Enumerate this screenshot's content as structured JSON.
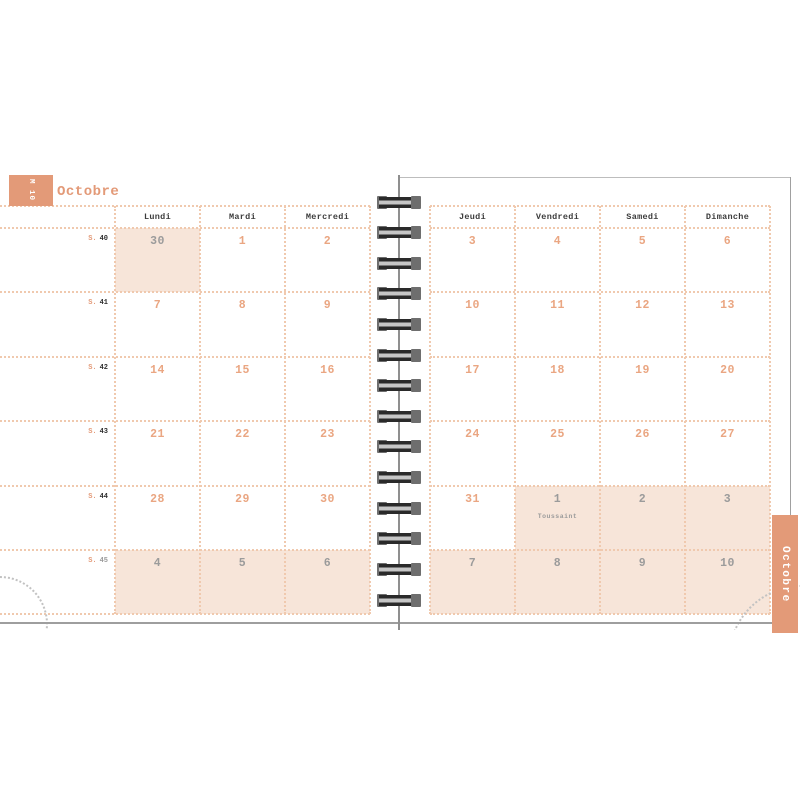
{
  "header": {
    "month_tab": "M 10",
    "title": "Octobre",
    "side_tab": "Octobre"
  },
  "colors": {
    "accent": "#E39A78",
    "cell_shade": "#F7E5D9",
    "day_number": "#EAA682",
    "muted_number": "#9B9B9B",
    "grid_dot": "#F0C9AE",
    "header_ink": "#3C3C3C",
    "week_ink": "#2E2E2E",
    "tab_text": "#FFFFFF",
    "ring_cap": "#6E6E6E",
    "ring_bar": "#2A2A2A"
  },
  "calendar": {
    "week_prefix": "S.",
    "left_day_headers": [
      "Lundi",
      "Mardi",
      "Mercredi"
    ],
    "right_day_headers": [
      "Jeudi",
      "Vendredi",
      "Samedi",
      "Dimanche"
    ],
    "weeks": [
      {
        "id": "40",
        "id_muted": false,
        "left": [
          {
            "day": "30",
            "muted": true,
            "shaded": true
          },
          {
            "day": "1"
          },
          {
            "day": "2"
          }
        ],
        "right": [
          {
            "day": "3"
          },
          {
            "day": "4"
          },
          {
            "day": "5"
          },
          {
            "day": "6"
          }
        ]
      },
      {
        "id": "41",
        "id_muted": false,
        "left": [
          {
            "day": "7"
          },
          {
            "day": "8"
          },
          {
            "day": "9"
          }
        ],
        "right": [
          {
            "day": "10"
          },
          {
            "day": "11"
          },
          {
            "day": "12"
          },
          {
            "day": "13"
          }
        ]
      },
      {
        "id": "42",
        "id_muted": false,
        "left": [
          {
            "day": "14"
          },
          {
            "day": "15"
          },
          {
            "day": "16"
          }
        ],
        "right": [
          {
            "day": "17"
          },
          {
            "day": "18"
          },
          {
            "day": "19"
          },
          {
            "day": "20"
          }
        ]
      },
      {
        "id": "43",
        "id_muted": false,
        "left": [
          {
            "day": "21"
          },
          {
            "day": "22"
          },
          {
            "day": "23"
          }
        ],
        "right": [
          {
            "day": "24"
          },
          {
            "day": "25"
          },
          {
            "day": "26"
          },
          {
            "day": "27"
          }
        ]
      },
      {
        "id": "44",
        "id_muted": false,
        "left": [
          {
            "day": "28"
          },
          {
            "day": "29"
          },
          {
            "day": "30"
          }
        ],
        "right": [
          {
            "day": "31"
          },
          {
            "day": "1",
            "muted": true,
            "shaded": true,
            "note": "Toussaint"
          },
          {
            "day": "2",
            "muted": true,
            "shaded": true
          },
          {
            "day": "3",
            "muted": true,
            "shaded": true
          }
        ]
      },
      {
        "id": "45",
        "id_muted": true,
        "left": [
          {
            "day": "4",
            "muted": true,
            "shaded": true
          },
          {
            "day": "5",
            "muted": true,
            "shaded": true
          },
          {
            "day": "6",
            "muted": true,
            "shaded": true
          }
        ],
        "right": [
          {
            "day": "7",
            "muted": true,
            "shaded": true
          },
          {
            "day": "8",
            "muted": true,
            "shaded": true
          },
          {
            "day": "9",
            "muted": true,
            "shaded": true
          },
          {
            "day": "10",
            "muted": true,
            "shaded": true
          }
        ]
      }
    ]
  }
}
